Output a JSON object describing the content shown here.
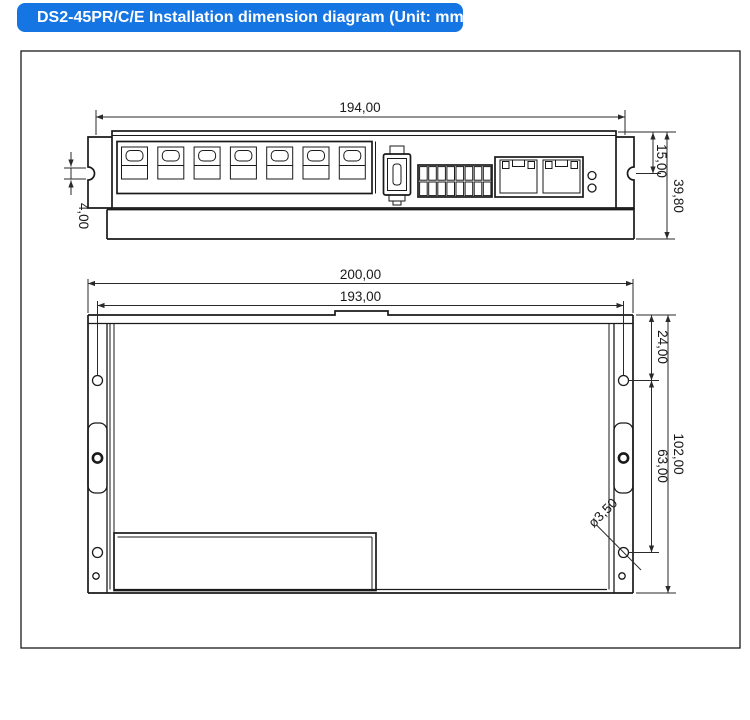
{
  "header": {
    "title": "DS2-45PR/C/E Installation dimension diagram (Unit: mm)"
  },
  "colors": {
    "banner_background": "#1576e3",
    "banner_text": "#ffffff",
    "drawing_lines": "#1a1a1a"
  },
  "top_view": {
    "dim_width": "194,00",
    "dim_notch": "4,00",
    "dim_top_offset": "15,00",
    "dim_height": "39,80"
  },
  "bottom_view": {
    "dim_outer_width": "200,00",
    "dim_inner_width": "193,00",
    "dim_hole_top": "24,00",
    "dim_hole_span": "63,00",
    "dim_height": "102,00",
    "dim_hole_diameter": "ø3,50"
  }
}
